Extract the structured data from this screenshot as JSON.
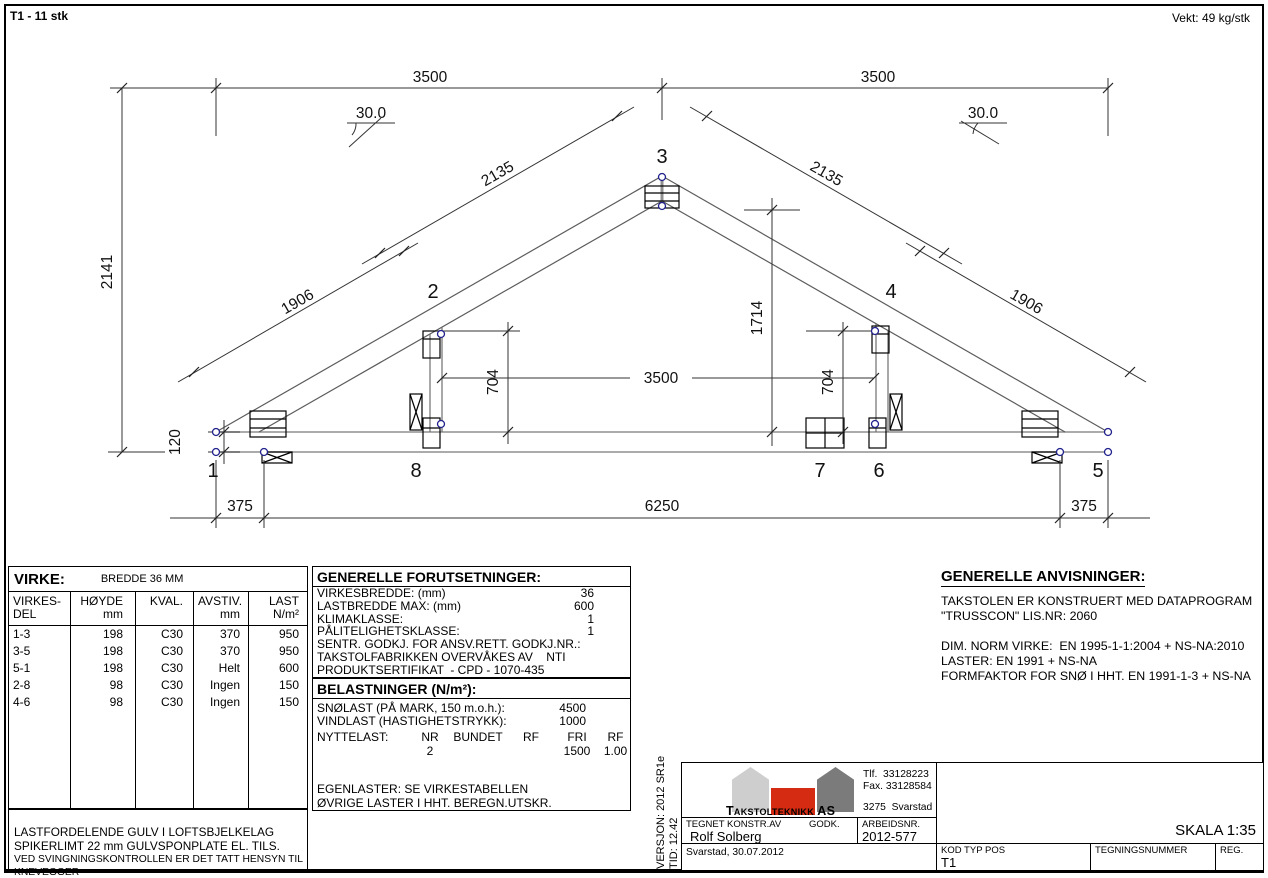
{
  "header": {
    "left": "T1 -  11 stk",
    "right": "Vekt: 49 kg/stk"
  },
  "truss": {
    "nodes": {
      "n1": "1",
      "n2": "2",
      "n3": "3",
      "n4": "4",
      "n5": "5",
      "n6": "6",
      "n7": "7",
      "n8": "8"
    },
    "dims": {
      "d3500_top_left": "3500",
      "d3500_top_right": "3500",
      "angle_left": "30.0",
      "angle_right": "30.0",
      "d2135_left": "2135",
      "d2135_right": "2135",
      "d1906_left": "1906",
      "d1906_right": "1906",
      "d2141": "2141",
      "d120": "120",
      "d1714": "1714",
      "d3500_mid": "3500",
      "d704_left": "704",
      "d704_right": "704",
      "d375_left": "375",
      "d6250": "6250",
      "d375_right": "375"
    }
  },
  "virke": {
    "title": "VIRKE:",
    "subtitle": "BREDDE 36 MM",
    "headers": {
      "h1a": "VIRKES-",
      "h1b": "DEL",
      "h2a": "HØYDE",
      "h2b": "mm",
      "h3": "KVAL.",
      "h4a": "AVSTIV.",
      "h4b": "mm",
      "h5a": "LAST",
      "h5b": "N/m²"
    },
    "rows": [
      [
        "1-3",
        "198",
        "C30",
        "370",
        "950"
      ],
      [
        "3-5",
        "198",
        "C30",
        "370",
        "950"
      ],
      [
        "5-1",
        "198",
        "C30",
        "Helt",
        "600"
      ],
      [
        "2-8",
        "98",
        "C30",
        "Ingen",
        "150"
      ],
      [
        "4-6",
        "98",
        "C30",
        "Ingen",
        "150"
      ]
    ]
  },
  "notes": {
    "l1": "LASTFORDELENDE GULV I LOFTSBJELKELAG",
    "l2": "SPIKERLIMT 22 mm GULVSPONPLATE EL. TILS.",
    "l3": "VED SVINGNINGSKONTROLLEN ER DET TATT HENSYN TIL KNEVEGGER"
  },
  "forutsetninger": {
    "title": "GENERELLE FORUTSETNINGER:",
    "rows": [
      {
        "label": "VIRKESBREDDE: (mm)",
        "value": "36"
      },
      {
        "label": "LASTBREDDE MAX: (mm)",
        "value": "600"
      },
      {
        "label": "KLIMAKLASSE:",
        "value": "1"
      },
      {
        "label": "PÅLITELIGHETSKLASSE:",
        "value": "1"
      },
      {
        "label": "SENTR. GODKJ. FOR ANSV.RETT. GODKJ.NR.:",
        "value": ""
      },
      {
        "label": "TAKSTOLFABRIKKEN OVERVÅKES AV    NTI",
        "value": ""
      },
      {
        "label": "PRODUKTSERTIFIKAT  - CPD - 1070-435",
        "value": ""
      }
    ]
  },
  "belastninger": {
    "title": "BELASTNINGER (N/m²):",
    "rows": [
      {
        "label": "SNØLAST (PÅ MARK, 150 m.o.h.):",
        "value": "4500"
      },
      {
        "label": "VINDLAST (HASTIGHETSTRYKK):",
        "value": "1000"
      }
    ],
    "nyttelast": {
      "label": "NYTTELAST:",
      "h1": "NR",
      "h2": "BUNDET",
      "h3": "RF",
      "h4": "FRI",
      "h5": "RF",
      "v1": "2",
      "v2": "",
      "v3": "",
      "v4": "1500",
      "v5": "1.00"
    },
    "footer1": "EGENLASTER: SE VIRKESTABELLEN",
    "footer2": "ØVRIGE LASTER I HHT. BEREGN.UTSKR."
  },
  "anvisninger": {
    "title": "GENERELLE ANVISNINGER:",
    "lines": [
      "TAKSTOLEN ER KONSTRUERT MED DATAPROGRAM",
      "\"TRUSSCON\" LIS.NR: 2060",
      "",
      "DIM. NORM VIRKE:  EN 1995-1-1:2004 + NS-NA:2010",
      "LASTER: EN 1991 + NS-NA",
      "FORMFAKTOR FOR SNØ I HHT. EN 1991-1-3 + NS-NA"
    ]
  },
  "titleblock": {
    "version_line1": "VERSJON: 2012 SR1e",
    "version_line2": "TID: 12.42",
    "company": "Takstolteknikk AS",
    "phone": "Tlf.  33128223",
    "fax": "Fax. 33128584",
    "city": "3275  Svarstad",
    "tegnet_label": "TEGNET KONSTR.AV",
    "godk_label": "GODK.",
    "arbeidsnr_label": "ARBEIDSNR.",
    "tegnet_value": "Rolf Solberg",
    "arbeidsnr_value": "2012-577",
    "place_date": "Svarstad, 30.07.2012",
    "skala": "SKALA 1:35",
    "kod_label": "KOD TYP POS",
    "kod_value": "T1",
    "tegningsnummer_label": "TEGNINGSNUMMER",
    "reg_label": "REG.",
    "colors": {
      "logo_left": "#cecece",
      "logo_right": "#7b7b7b",
      "logo_accent": "#d52b12"
    }
  }
}
